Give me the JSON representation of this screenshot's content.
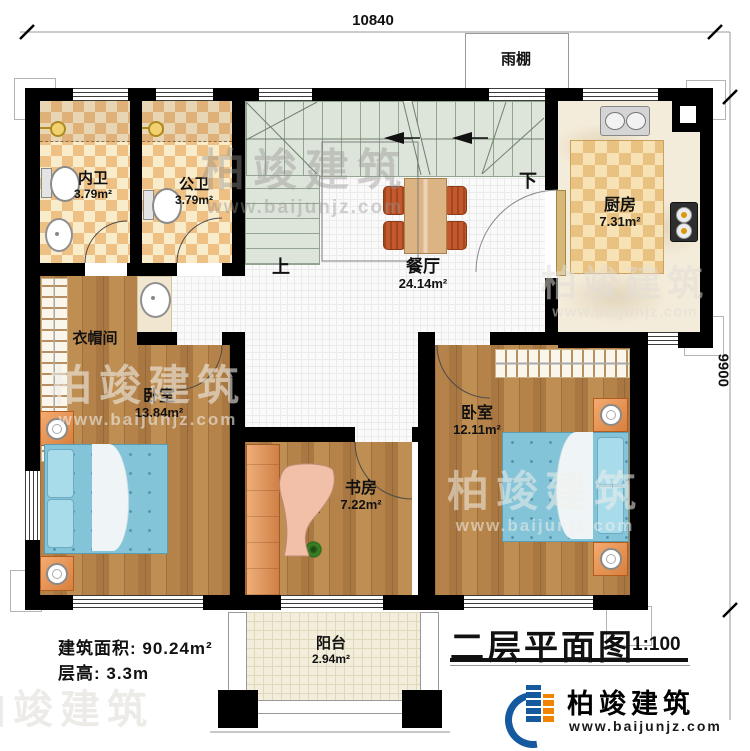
{
  "dimensions": {
    "top": "10840",
    "right": "9900"
  },
  "canopy": {
    "label": "雨棚"
  },
  "stairs": {
    "up": "上",
    "down": "下"
  },
  "rooms": {
    "inner_bath": {
      "name": "内卫",
      "area": "3.79m²"
    },
    "public_bath": {
      "name": "公卫",
      "area": "3.79m²"
    },
    "kitchen": {
      "name": "厨房",
      "area": "7.31m²"
    },
    "dining": {
      "name": "餐厅",
      "area": "24.14m²"
    },
    "cloakroom": {
      "name": "衣帽间"
    },
    "bedroom_left": {
      "name": "卧室",
      "area": "13.84m²"
    },
    "bedroom_right": {
      "name": "卧室",
      "area": "12.11m²"
    },
    "study": {
      "name": "书房",
      "area": "7.22m²"
    },
    "balcony": {
      "name": "阳台",
      "area": "2.94m²"
    }
  },
  "notes": {
    "building_area": "建筑面积: 90.24m²",
    "floor_height": "层高: 3.3m"
  },
  "title": {
    "name": "二层平面图",
    "scale": "1:100"
  },
  "brand": {
    "name": "柏竣建筑",
    "website": "www.baijunjz.com"
  },
  "fixtures": [
    "toilet",
    "wash-basin",
    "pedestal-sink",
    "kitchen-sink",
    "gas-stove",
    "dining-table",
    "chair",
    "bed",
    "pillow",
    "nightstand",
    "wardrobe-hangers",
    "desk",
    "computer-monitor",
    "laptop",
    "plant",
    "ceiling-light",
    "stairs",
    "door-arc",
    "window"
  ],
  "colors": {
    "wall": "#000000",
    "stair_green": "#dde4d9",
    "wood": "#b5834a",
    "tile_check": "#eec084",
    "bed_blue": "#84c4d9",
    "furniture_orange": "#c4582b",
    "brand_blue": "#15599f",
    "brand_orange": "#f08300"
  }
}
